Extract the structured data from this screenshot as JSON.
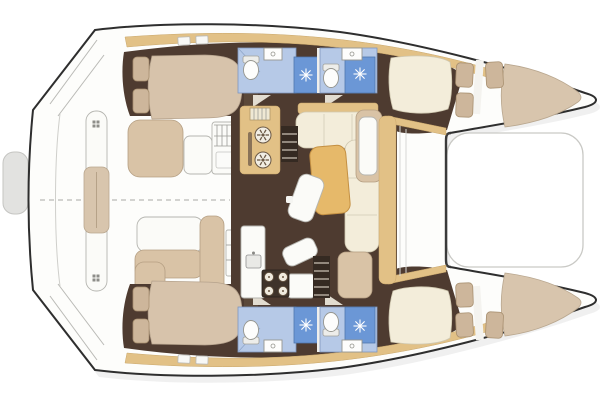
{
  "meta": {
    "title": "Catamaran yacht accommodation floor plan",
    "view": "top-down deck plan rendering",
    "orientation": {
      "bow": "right",
      "stern": "left"
    },
    "text_labels_visible": "none"
  },
  "palette": {
    "background": "#ffffff",
    "hull_outline": "#2e2e2e",
    "deck_white": "#fdfdfb",
    "sidedeck_tan": "#e2c186",
    "interior_brown": "#4e3b30",
    "interior_brown_light": "#5b4839",
    "mattress_tan": "#d7c3ab",
    "pillow_tan": "#cdb69b",
    "duvet_tan": "#d8c5ad",
    "sofa_cream": "#f3edda",
    "table_wood": "#e6b96a",
    "cockpit_cushion": "#d9c3a6",
    "bath_floor_blue": "#b6c9e7",
    "shower_blue": "#6b97d6",
    "stove_dark": "#3f332a"
  },
  "vessel": {
    "type": "sailing catamaran",
    "layout": "4 cabins / 4 shower heads, central saloon with galley, aft cockpit, bow trampoline",
    "areas": {
      "aft_platform": {
        "label": "stern platforms",
        "items": [
          "port-swim-platform-steps",
          "aft-crossbeam-platform",
          "starboard-swim-platform-steps",
          "dinghy-pad"
        ]
      },
      "cockpit": {
        "label": "aft cockpit",
        "items": [
          "full-beam-aft-bench",
          "aft-bench-cushion",
          "port-settee",
          "port-coffee-table",
          "cockpit-grill-module",
          "starboard-dining-table",
          "starboard-l-settee",
          "bulkhead-seat",
          "centerline-dashed"
        ]
      },
      "saloon": {
        "label": "main saloon",
        "items": [
          "galley-tall-unit-two-burners",
          "sink-drainer-grid",
          "port-companionway-steps",
          "l-shaped-sofa",
          "wood-dining-table",
          "rotated-stool",
          "rotated-stool-2",
          "forward-chaise-cushion",
          "front-sideboard",
          "nav-seat",
          "aft-galley-counter",
          "galley-sink",
          "four-burner-stove",
          "starboard-companionway-steps"
        ]
      },
      "port_hull": {
        "label": "port hull (top)",
        "rooms": [
          "aft-double-cabin",
          "aft-head-with-shower",
          "forward-head-with-shower",
          "forward-double-cabin",
          "bow-berth"
        ]
      },
      "starboard_hull": {
        "label": "starboard hull (bottom)",
        "rooms": [
          "aft-double-cabin",
          "aft-head-with-shower",
          "forward-head-with-shower",
          "forward-double-cabin",
          "bow-berth"
        ]
      },
      "foredeck": {
        "label": "foredeck",
        "items": [
          "trampoline",
          "forward-crossbeam"
        ]
      }
    }
  }
}
